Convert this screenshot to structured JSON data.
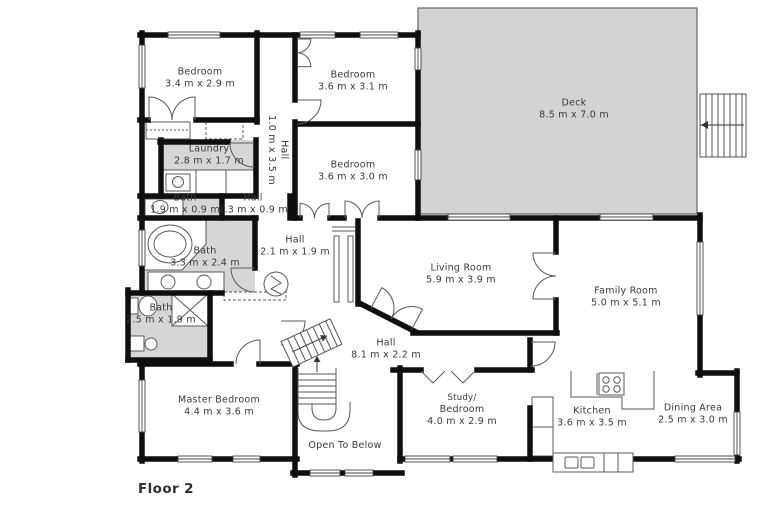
{
  "floor_plan": {
    "floor_label": "Floor 2",
    "rooms": [
      {
        "name": "Bedroom",
        "dims": "3.4 m x 2.9 m"
      },
      {
        "name": "Bedroom",
        "dims": "3.6 m x 3.1 m"
      },
      {
        "name": "Deck",
        "dims": "8.5 m x 7.0 m"
      },
      {
        "name": "Hall",
        "dims": "1.0 m x 3.5 m"
      },
      {
        "name": "Bedroom",
        "dims": "3.6 m x 3.0 m"
      },
      {
        "name": "Laundry",
        "dims": "2.8 m x 1.7 m"
      },
      {
        "name": "Bath",
        "dims": "1.9 m x 0.9 m"
      },
      {
        "name": "Hall",
        "dims": "2.3 m x 0.9 m"
      },
      {
        "name": "Bath",
        "dims": "3.3 m x 2.4 m"
      },
      {
        "name": "Hall",
        "dims": "2.1 m x 1.9 m"
      },
      {
        "name": "Living Room",
        "dims": "5.9 m x 3.9 m"
      },
      {
        "name": "Family Room",
        "dims": "5.0 m x 5.1 m"
      },
      {
        "name": "Bath",
        "dims": "2.5 m x 1.9 m"
      },
      {
        "name": "Hall",
        "dims": "8.1 m x 2.2 m"
      },
      {
        "name": "Master Bedroom",
        "dims": "4.4 m x 3.6 m"
      },
      {
        "name": "Open To Below",
        "dims": ""
      },
      {
        "name": "Study/",
        "name2": "Bedroom",
        "dims": "4.0 m x 2.9 m"
      },
      {
        "name": "Kitchen",
        "dims": "3.6 m x 3.5 m"
      },
      {
        "name": "Dining Area",
        "dims": "2.5 m x 3.0 m"
      }
    ],
    "colors": {
      "walls": "#0f0f0f",
      "shaded_room_fill": "#d6d6d6",
      "deck_fill": "#d3d3d3",
      "label_text": "#3a3a3a",
      "background": "#ffffff"
    },
    "fixtures": [
      "interior-staircase",
      "deck-staircase",
      "bathtub",
      "double-vanity",
      "toilet",
      "shower",
      "laundry-sink",
      "washer-dryer",
      "water-heater",
      "stove",
      "kitchen-sink",
      "kitchen-island",
      "closet",
      "door-swing",
      "window"
    ]
  }
}
